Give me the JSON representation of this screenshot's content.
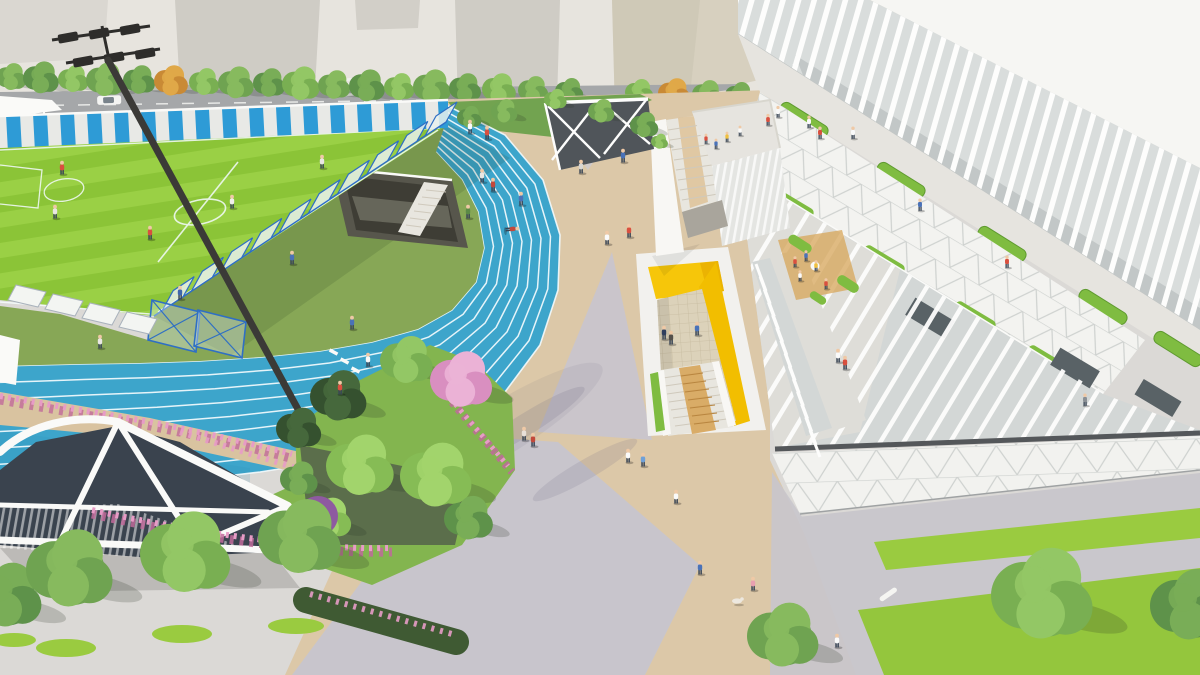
{
  "scene": {
    "description": "Aerial 3D architectural rendering of a school sports campus: an 8-lane blue running track curving around a striped green soccer field (upper left), a floodlight mast, a central beige pedestrian plaza, a sunken courtyard with bright yellow walls and a grand timber stair, a long white sports building with vertical louver fins and planted roof terraces (right), a white steel entrance canopy over dark glass (lower left), gardens with cherry-blossom trees, pink hedges and street trees, and many small pedestrians.",
    "type": "architectural-render",
    "view": "aerial-oblique"
  },
  "track": {
    "lanes": 8,
    "surface_color": "#3DA5CB",
    "lane_line_color": "#F4FBFD"
  },
  "palette": {
    "base": "#DBD9D6",
    "bgStrip": "#E7E4DE",
    "block1": "#DAD7D1",
    "block2": "#CFCCC5",
    "block3": "#D2CFC8",
    "beigeWall": "#D7D0BF",
    "beigeWallShade": "#C9C2B0",
    "roadGrey": "#A5A7A9",
    "bikeStrip": "#8E9294",
    "sidewalk": "#D3D0C8",
    "roadLine": "#F2F3F1",
    "trackBlue": "#3DA5CB",
    "trackShade": "#2E8CB2",
    "laneWhite": "#F4FBFD",
    "fieldLight": "#9AD045",
    "fieldDark": "#8BC437",
    "apron": "#87A756",
    "apronShadow": "#1F3A1F",
    "pitDark": "#3E3D35",
    "pitWall": "#57564C",
    "pitRamp": "#6A6A5E",
    "stairWhite": "#E8E6DF",
    "fenceBlue": "#2F6FC4",
    "fenceGlass": "#E9F1ED",
    "wallBandBlue": "#2E9BD6",
    "wallBandWhite": "#E8E9E6",
    "poleDark": "#3B3A37",
    "lampDark": "#2E2D2B",
    "plazaBeige": "#DCC8A8",
    "plazaGrey": "#C8C5CC",
    "plazaGrey2": "#CDCAD1",
    "shadowViolet": "#6E6884",
    "pathTan": "#D9C3A0",
    "hedgeBank": "#72A350",
    "gardenGrass": "#83B54F",
    "gardenDark": "#55624A",
    "hedgeDark": "#3F5A33",
    "pinkA": "#E79CC6",
    "pinkB": "#C06A9A",
    "purple": "#8E5AA0",
    "canopyGlass": "#3A434E",
    "canopyWhite": "#FAFAF8",
    "lawnGreen": "#9ACB40",
    "lawnGreen2": "#94C63D",
    "groundGrey": "#C9C7CC",
    "roofWhite": "#F6F6F3",
    "finBase": "#D9DDDC",
    "finShadow": "#A7AEAD",
    "finWhite": "#FDFDFC",
    "promenade": "#E6E4DF",
    "planterGreen": "#7FBC41",
    "planterEdge": "#5E9A2F",
    "wingWhite": "#F3F3F0",
    "triLine": "#C5C9C7",
    "glassBand": "#D3D7D6",
    "walkLight": "#DEDDD8",
    "darkWindow": "#596266",
    "eave": "#54575A",
    "latticeGround": "#F2F2EF",
    "yellowA": "#F6C60A",
    "yellowB": "#F2BE00",
    "yellowDeep": "#E8AE00",
    "courtWhite": "#F2F1EE",
    "tileFloor": "#DCD2BA",
    "tileLine": "#C4B89C",
    "wood": "#D7A55A",
    "woodDark": "#B8853F",
    "stepLine": "#CFC9BC",
    "pavWhite": "#F8F7F4",
    "louverWall": "#E4E5E2",
    "gateDark": "#50555A",
    "teal": "#49A9A4",
    "benchWhite": "#F5F5F2",
    "skin": "#EFC9A6",
    "pants": "#3A4656",
    "dogWhite": "#EDE8DF",
    "treeVariants": {
      "g1": [
        "#6FA351",
        "#87BA5E"
      ],
      "g2": [
        "#5E924A",
        "#79AD57"
      ],
      "g3": [
        "#79AF52",
        "#93C765"
      ],
      "orange": [
        "#C98A35",
        "#E0A848"
      ],
      "conifer": [
        "#35512F",
        "#46683C"
      ],
      "pink": [
        "#D98FC0",
        "#EBB2D6"
      ],
      "light": [
        "#86BC55",
        "#A2D46C"
      ]
    }
  },
  "fence_diagonal": {
    "x1": 446,
    "y1": 122,
    "x2": 154,
    "y2": 316,
    "count": 10
  },
  "cars": [
    {
      "x": 97,
      "y": 96,
      "w": 24,
      "h": 9,
      "c": "#F4F4F2"
    },
    {
      "x": 620,
      "y": 103,
      "w": 20,
      "h": 8,
      "c": "#F2F2F0"
    }
  ],
  "trees": {
    "street": [
      {
        "x": 12,
        "y": 78,
        "r": 16,
        "v": "g1"
      },
      {
        "x": 42,
        "y": 79,
        "r": 19,
        "v": "g2"
      },
      {
        "x": 74,
        "y": 80,
        "r": 16,
        "v": "g3"
      },
      {
        "x": 106,
        "y": 81,
        "r": 20,
        "v": "g1"
      },
      {
        "x": 140,
        "y": 81,
        "r": 17,
        "v": "g2"
      },
      {
        "x": 172,
        "y": 82,
        "r": 18,
        "v": "orange"
      },
      {
        "x": 205,
        "y": 83,
        "r": 16,
        "v": "g3"
      },
      {
        "x": 237,
        "y": 84,
        "r": 19,
        "v": "g1"
      },
      {
        "x": 270,
        "y": 84,
        "r": 17,
        "v": "g2"
      },
      {
        "x": 302,
        "y": 85,
        "r": 20,
        "v": "g3"
      },
      {
        "x": 335,
        "y": 86,
        "r": 17,
        "v": "g1"
      },
      {
        "x": 368,
        "y": 87,
        "r": 19,
        "v": "g2"
      },
      {
        "x": 400,
        "y": 88,
        "r": 16,
        "v": "g3"
      },
      {
        "x": 433,
        "y": 88,
        "r": 20,
        "v": "g1"
      },
      {
        "x": 466,
        "y": 89,
        "r": 17,
        "v": "g2"
      },
      {
        "x": 500,
        "y": 90,
        "r": 18,
        "v": "g3"
      },
      {
        "x": 534,
        "y": 91,
        "r": 16,
        "v": "g1"
      },
      {
        "x": 570,
        "y": 92,
        "r": 15,
        "v": "g2"
      },
      {
        "x": 640,
        "y": 93,
        "r": 15,
        "v": "g3"
      },
      {
        "x": 675,
        "y": 94,
        "r": 17,
        "v": "orange"
      },
      {
        "x": 708,
        "y": 95,
        "r": 16,
        "v": "g1"
      },
      {
        "x": 740,
        "y": 96,
        "r": 15,
        "v": "g2"
      }
    ],
    "flank": [
      {
        "x": 470,
        "y": 118,
        "r": 13,
        "v": "g2"
      },
      {
        "x": 505,
        "y": 112,
        "r": 14,
        "v": "g1"
      },
      {
        "x": 556,
        "y": 100,
        "r": 12,
        "v": "g3"
      },
      {
        "x": 602,
        "y": 112,
        "r": 14,
        "v": "g1"
      },
      {
        "x": 645,
        "y": 126,
        "r": 15,
        "v": "g2"
      },
      {
        "x": 660,
        "y": 142,
        "r": 9,
        "v": "g3"
      }
    ],
    "garden": [
      {
        "x": 340,
        "y": 398,
        "r": 30,
        "v": "conifer"
      },
      {
        "x": 300,
        "y": 430,
        "r": 24,
        "v": "conifer"
      },
      {
        "x": 362,
        "y": 468,
        "r": 36,
        "v": "light"
      },
      {
        "x": 438,
        "y": 478,
        "r": 38,
        "v": "light"
      },
      {
        "x": 408,
        "y": 362,
        "r": 28,
        "v": "g3"
      },
      {
        "x": 470,
        "y": 520,
        "r": 26,
        "v": "g2"
      },
      {
        "x": 330,
        "y": 520,
        "r": 24,
        "v": "light"
      },
      {
        "x": 463,
        "y": 382,
        "r": 33,
        "v": "pink"
      },
      {
        "x": 300,
        "y": 480,
        "r": 20,
        "v": "g2"
      }
    ],
    "bottom": [
      {
        "x": 8,
        "y": 598,
        "r": 38,
        "v": "g2"
      },
      {
        "x": 72,
        "y": 572,
        "r": 46,
        "v": "g1"
      },
      {
        "x": 188,
        "y": 556,
        "r": 48,
        "v": "g3"
      },
      {
        "x": 302,
        "y": 540,
        "r": 44,
        "v": "g1"
      }
    ],
    "right": [
      {
        "x": 1045,
        "y": 598,
        "r": 54,
        "v": "g3"
      },
      {
        "x": 1192,
        "y": 608,
        "r": 42,
        "v": "g2"
      },
      {
        "x": 785,
        "y": 638,
        "r": 38,
        "v": "g1"
      }
    ]
  },
  "people": [
    {
      "x": 55,
      "y": 212,
      "c": "#E9E7E3"
    },
    {
      "x": 150,
      "y": 233,
      "c": "#D9503F"
    },
    {
      "x": 232,
      "y": 202,
      "c": "#F0EFEA"
    },
    {
      "x": 292,
      "y": 258,
      "c": "#4A72B8"
    },
    {
      "x": 180,
      "y": 293,
      "c": "#3F66AC"
    },
    {
      "x": 322,
      "y": 162,
      "c": "#E9E7E3"
    },
    {
      "x": 62,
      "y": 168,
      "c": "#D9503F"
    },
    {
      "x": 482,
      "y": 176,
      "c": "#E9E7E3"
    },
    {
      "x": 493,
      "y": 185,
      "c": "#C2493B"
    },
    {
      "x": 521,
      "y": 199,
      "c": "#4A72B8"
    },
    {
      "x": 512,
      "y": 229,
      "c": "#C2493B",
      "r": 85
    },
    {
      "x": 468,
      "y": 212,
      "c": "#5B8A46"
    },
    {
      "x": 470,
      "y": 127,
      "c": "#FAFAFA"
    },
    {
      "x": 487,
      "y": 133,
      "c": "#D9503F"
    },
    {
      "x": 352,
      "y": 323,
      "c": "#4A72B8"
    },
    {
      "x": 368,
      "y": 360,
      "c": "#FAFAFA"
    },
    {
      "x": 340,
      "y": 388,
      "c": "#D9503F"
    },
    {
      "x": 100,
      "y": 342,
      "c": "#E9E7E3"
    },
    {
      "x": 581,
      "y": 167,
      "c": "#D8D6D3"
    },
    {
      "x": 623,
      "y": 156,
      "c": "#4A72B8"
    },
    {
      "x": 607,
      "y": 238,
      "c": "#FAFAFA"
    },
    {
      "x": 629,
      "y": 231,
      "c": "#D9503F"
    },
    {
      "x": 524,
      "y": 434,
      "c": "#E8E0D8"
    },
    {
      "x": 533,
      "y": 440,
      "c": "#C2493B"
    },
    {
      "x": 628,
      "y": 456,
      "c": "#FAFAFA"
    },
    {
      "x": 643,
      "y": 460,
      "c": "#6FA0D8"
    },
    {
      "x": 676,
      "y": 497,
      "c": "#FAFAFA"
    },
    {
      "x": 753,
      "y": 584,
      "c": "#E8A0B0"
    },
    {
      "x": 700,
      "y": 568,
      "c": "#4A72B8"
    },
    {
      "x": 837,
      "y": 641,
      "c": "#FAFAFA"
    },
    {
      "x": 664,
      "y": 333,
      "c": "#2F3E5E"
    },
    {
      "x": 671,
      "y": 338,
      "c": "#55504A"
    },
    {
      "x": 697,
      "y": 329,
      "c": "#4A72B8"
    },
    {
      "x": 845,
      "y": 363,
      "c": "#D9503F"
    },
    {
      "x": 838,
      "y": 356,
      "c": "#FAFAFA"
    },
    {
      "x": 809,
      "y": 122,
      "c": "#FAFAFA",
      "s": 0.9
    },
    {
      "x": 820,
      "y": 133,
      "c": "#D9503F",
      "s": 0.9
    },
    {
      "x": 853,
      "y": 133,
      "c": "#FAFAFA",
      "s": 0.9
    },
    {
      "x": 920,
      "y": 205,
      "c": "#4A72B8",
      "s": 0.9
    },
    {
      "x": 1007,
      "y": 262,
      "c": "#D9503F",
      "s": 0.9
    },
    {
      "x": 768,
      "y": 120,
      "c": "#D9503F",
      "s": 0.85
    },
    {
      "x": 778,
      "y": 112,
      "c": "#FAFAFA",
      "s": 0.85
    },
    {
      "x": 706,
      "y": 139,
      "c": "#D9503F",
      "s": 0.75
    },
    {
      "x": 716,
      "y": 144,
      "c": "#4A72B8",
      "s": 0.75
    },
    {
      "x": 727,
      "y": 137,
      "c": "#EFC040",
      "s": 0.75
    },
    {
      "x": 740,
      "y": 131,
      "c": "#FAFAFA",
      "s": 0.75
    },
    {
      "x": 795,
      "y": 262,
      "c": "#D9503F",
      "s": 0.8
    },
    {
      "x": 806,
      "y": 256,
      "c": "#4A72B8",
      "s": 0.8
    },
    {
      "x": 816,
      "y": 266,
      "c": "#EFC040",
      "s": 0.8
    },
    {
      "x": 800,
      "y": 276,
      "c": "#FAFAFA",
      "s": 0.8
    },
    {
      "x": 826,
      "y": 284,
      "c": "#D9503F",
      "s": 0.8
    },
    {
      "x": 1085,
      "y": 400,
      "c": "#8A8F94",
      "s": 0.9
    }
  ]
}
